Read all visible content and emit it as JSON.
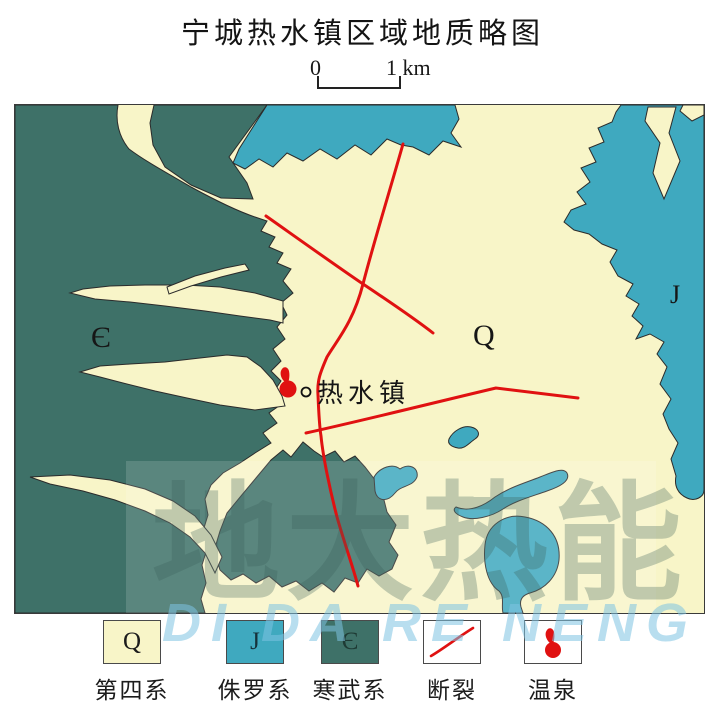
{
  "title": "宁城热水镇区域地质略图",
  "scale_bar": {
    "start_label": "0",
    "end_label": "1 km"
  },
  "map": {
    "region_labels": {
      "cambrian": "Є",
      "quaternary": "Q",
      "jurassic": "J"
    },
    "town": {
      "name": "热水镇"
    }
  },
  "legend": {
    "items": [
      {
        "symbol": "Q",
        "label": "第四系"
      },
      {
        "symbol": "J",
        "label": "侏罗系"
      },
      {
        "symbol": "Є",
        "label": "寒武系"
      },
      {
        "symbol": "",
        "label": "断裂"
      },
      {
        "symbol": "",
        "label": "温泉"
      }
    ]
  },
  "watermark": {
    "cn": "地大热能",
    "en": "DI DA RE NENG"
  },
  "colors": {
    "quaternary": "#F8F5C8",
    "jurassic": "#3FA9BF",
    "cambrian": "#3E7168",
    "fault": "#E01111",
    "spring": "#E01111",
    "watermark_cn": "rgba(60,95,88,0.30)",
    "watermark_en": "rgba(125,195,225,0.55)"
  }
}
